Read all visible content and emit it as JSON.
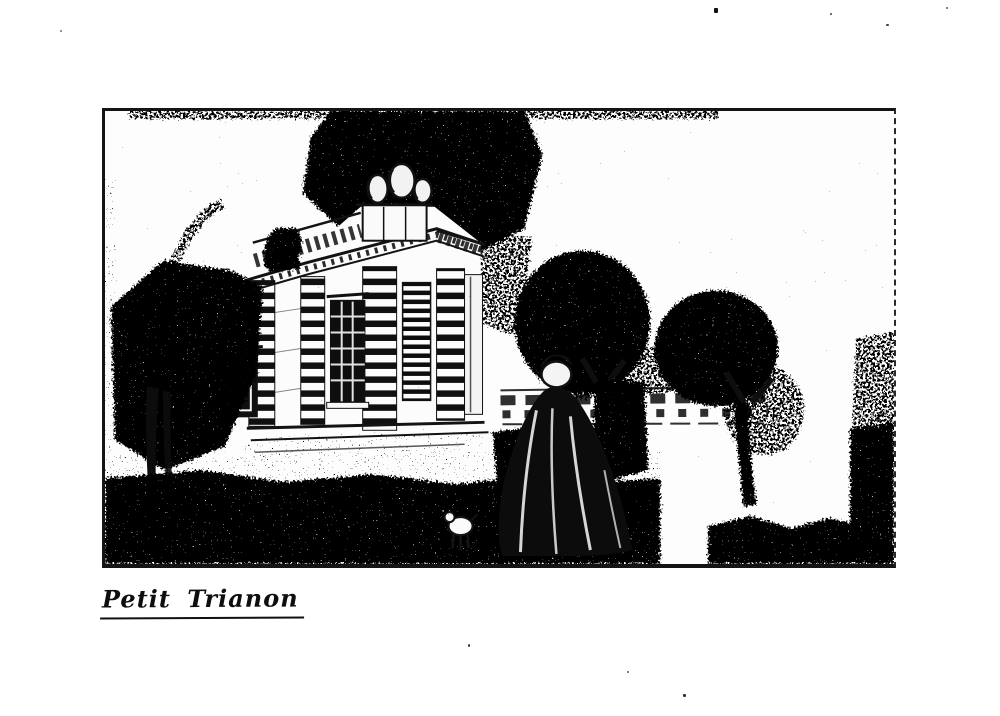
{
  "page": {
    "background": "#ffffff",
    "ink_color": "#111111"
  },
  "figure": {
    "caption": "Petit Trianon",
    "alt": "Halftone engraving of the Petit Trianon pavilion seen across a lawn, with tall trees, a distant fence, and a woman in an eighteenth-century gown and bonnet walking away"
  }
}
